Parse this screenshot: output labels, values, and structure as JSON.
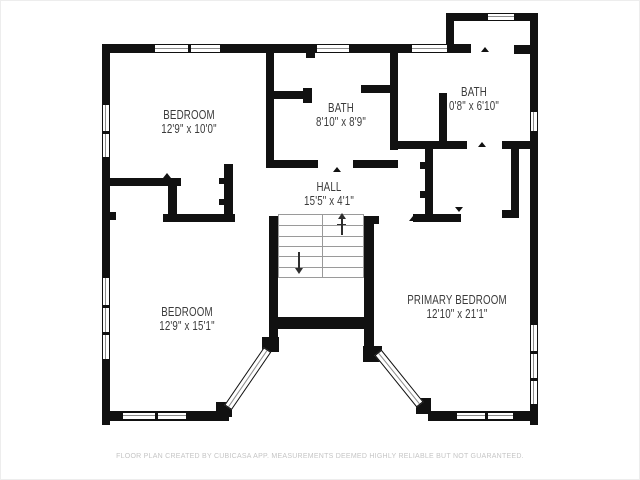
{
  "colors": {
    "wall": "#111111",
    "label": "#3b3b3b",
    "stair": "#9a9a9a",
    "glass": "#8c8c8c",
    "footer": "#c5c5c5"
  },
  "footer": {
    "text": "FLOOR PLAN CREATED BY CUBICASA APP. MEASUREMENTS DEEMED HIGHLY RELIABLE BUT NOT GUARANTEED."
  },
  "rooms": [
    {
      "id": "bedroom-top-left",
      "name": "BEDROOM",
      "dims": "12'9\" x 10'0\"",
      "cx": 188,
      "cy": 121
    },
    {
      "id": "bath-middle",
      "name": "BATH",
      "dims": "8'10\" x 8'9\"",
      "cx": 340,
      "cy": 114
    },
    {
      "id": "bath-top-right",
      "name": "BATH",
      "dims": "0'8\" x 6'10\"",
      "cx": 473,
      "cy": 98
    },
    {
      "id": "hall",
      "name": "HALL",
      "dims": "15'5\" x 4'1\"",
      "cx": 328,
      "cy": 193
    },
    {
      "id": "primary-bedroom",
      "name": "PRIMARY BEDROOM",
      "dims": "12'10\" x 21'1\"",
      "cx": 456,
      "cy": 306
    },
    {
      "id": "bedroom-bottom-left",
      "name": "BEDROOM",
      "dims": "12'9\" x 15'1\"",
      "cx": 186,
      "cy": 318
    }
  ],
  "plan": {
    "walls": [
      [
        101,
        43,
        8,
        381
      ],
      [
        101,
        43,
        369,
        9
      ],
      [
        445,
        12,
        8,
        40
      ],
      [
        445,
        12,
        92,
        8
      ],
      [
        529,
        12,
        8,
        412
      ],
      [
        513,
        44,
        17,
        9
      ],
      [
        101,
        410,
        127,
        10
      ],
      [
        215,
        401,
        16,
        15
      ],
      [
        427,
        410,
        110,
        10
      ],
      [
        415,
        397,
        15,
        16
      ],
      [
        270,
        316,
        103,
        12
      ],
      [
        268,
        215,
        9,
        133
      ],
      [
        261,
        336,
        17,
        15
      ],
      [
        363,
        215,
        10,
        135
      ],
      [
        362,
        345,
        19,
        16
      ],
      [
        363,
        215,
        15,
        8
      ],
      [
        265,
        51,
        8,
        115
      ],
      [
        273,
        90,
        31,
        8
      ],
      [
        302,
        87,
        9,
        15
      ],
      [
        305,
        51,
        9,
        6
      ],
      [
        389,
        51,
        8,
        98
      ],
      [
        360,
        84,
        29,
        8
      ],
      [
        265,
        159,
        52,
        8
      ],
      [
        352,
        159,
        45,
        8
      ],
      [
        397,
        140,
        69,
        8
      ],
      [
        501,
        140,
        29,
        8
      ],
      [
        438,
        92,
        8,
        48
      ],
      [
        424,
        148,
        8,
        69
      ],
      [
        510,
        146,
        8,
        71
      ],
      [
        501,
        209,
        17,
        8
      ],
      [
        412,
        213,
        48,
        8
      ],
      [
        162,
        213,
        72,
        8
      ],
      [
        109,
        177,
        71,
        8
      ],
      [
        167,
        183,
        9,
        32
      ],
      [
        223,
        163,
        9,
        52
      ],
      [
        109,
        211,
        6,
        8
      ],
      [
        419,
        161,
        5,
        7
      ],
      [
        419,
        190,
        5,
        7
      ],
      [
        218,
        177,
        5,
        6
      ],
      [
        218,
        198,
        5,
        6
      ]
    ],
    "windows": [
      [
        153,
        43,
        67,
        9,
        2,
        "h"
      ],
      [
        315,
        43,
        34,
        9,
        1,
        "h"
      ],
      [
        410,
        43,
        37,
        9,
        1,
        "h"
      ],
      [
        486,
        12,
        28,
        8,
        1,
        "h"
      ],
      [
        529,
        110,
        8,
        21,
        1,
        "v"
      ],
      [
        529,
        323,
        8,
        81,
        3,
        "v"
      ],
      [
        101,
        103,
        8,
        54,
        2,
        "v"
      ],
      [
        101,
        276,
        8,
        83,
        3,
        "v"
      ],
      [
        121,
        411,
        65,
        8,
        2,
        "h"
      ],
      [
        455,
        411,
        58,
        8,
        2,
        "h"
      ]
    ],
    "bay_windows": [
      {
        "x": 227,
        "y": 401.5,
        "len": 70,
        "angle": -55.6
      },
      {
        "x": 377,
        "y": 346.5,
        "len": 67,
        "angle": 51.1
      }
    ],
    "stairs": {
      "x": 277,
      "y": 213,
      "w": 86,
      "h": 64,
      "tread_lines": 5
    },
    "stair_arrows": [
      {
        "x": 340,
        "y": 217,
        "len": 17,
        "dir": "up"
      },
      {
        "x": 297,
        "y": 251,
        "len": 17,
        "dir": "down"
      }
    ],
    "door_markers": [
      {
        "x": 336,
        "y": 166,
        "rot": 0
      },
      {
        "x": 173,
        "y": 216,
        "rot": 180
      },
      {
        "x": 166,
        "y": 172,
        "rot": 0
      },
      {
        "x": 484,
        "y": 46,
        "rot": 0
      },
      {
        "x": 481,
        "y": 141,
        "rot": 0
      },
      {
        "x": 412,
        "y": 215,
        "rot": 0
      },
      {
        "x": 458,
        "y": 206,
        "rot": 180
      }
    ]
  }
}
